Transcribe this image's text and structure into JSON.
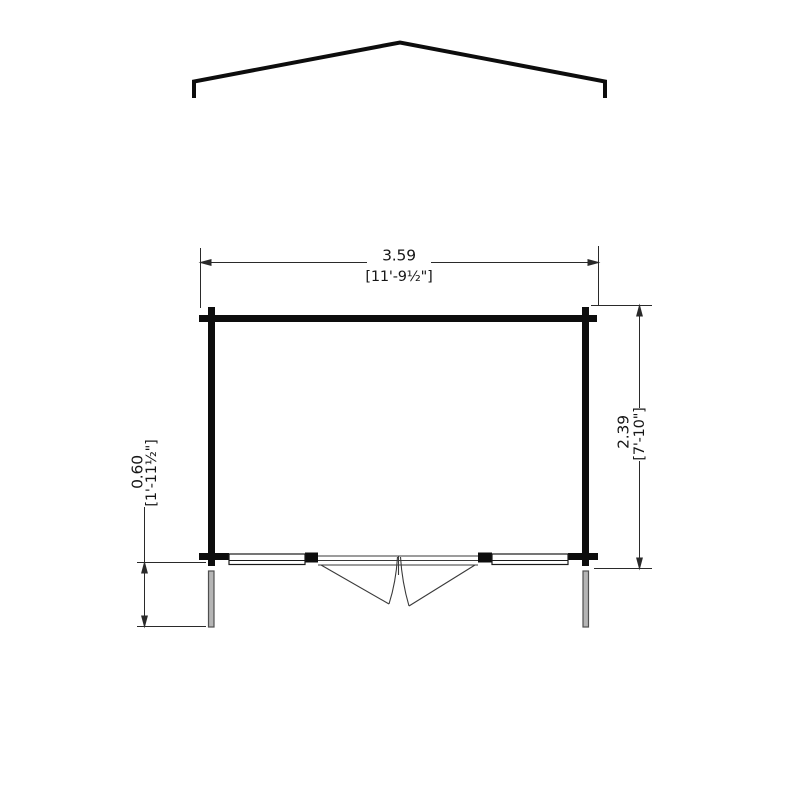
{
  "drawing": {
    "kind": "log-cabin-floor-plan",
    "dimensions": {
      "width": {
        "metric": "3.59",
        "imperial": "[11'-9½\"]"
      },
      "depth": {
        "metric": "2.39",
        "imperial": "[7'-10\"]"
      },
      "overhang": {
        "metric": "0.60",
        "imperial": "[1'-11½\"]"
      }
    },
    "colors": {
      "wall_line": "#0d0d0d",
      "dimension_line": "#2a2a2a",
      "door_line": "#3a3a3a",
      "post_fill": "#b5b5b5",
      "post_stroke": "#4f4f4f",
      "background": "#ffffff"
    }
  }
}
